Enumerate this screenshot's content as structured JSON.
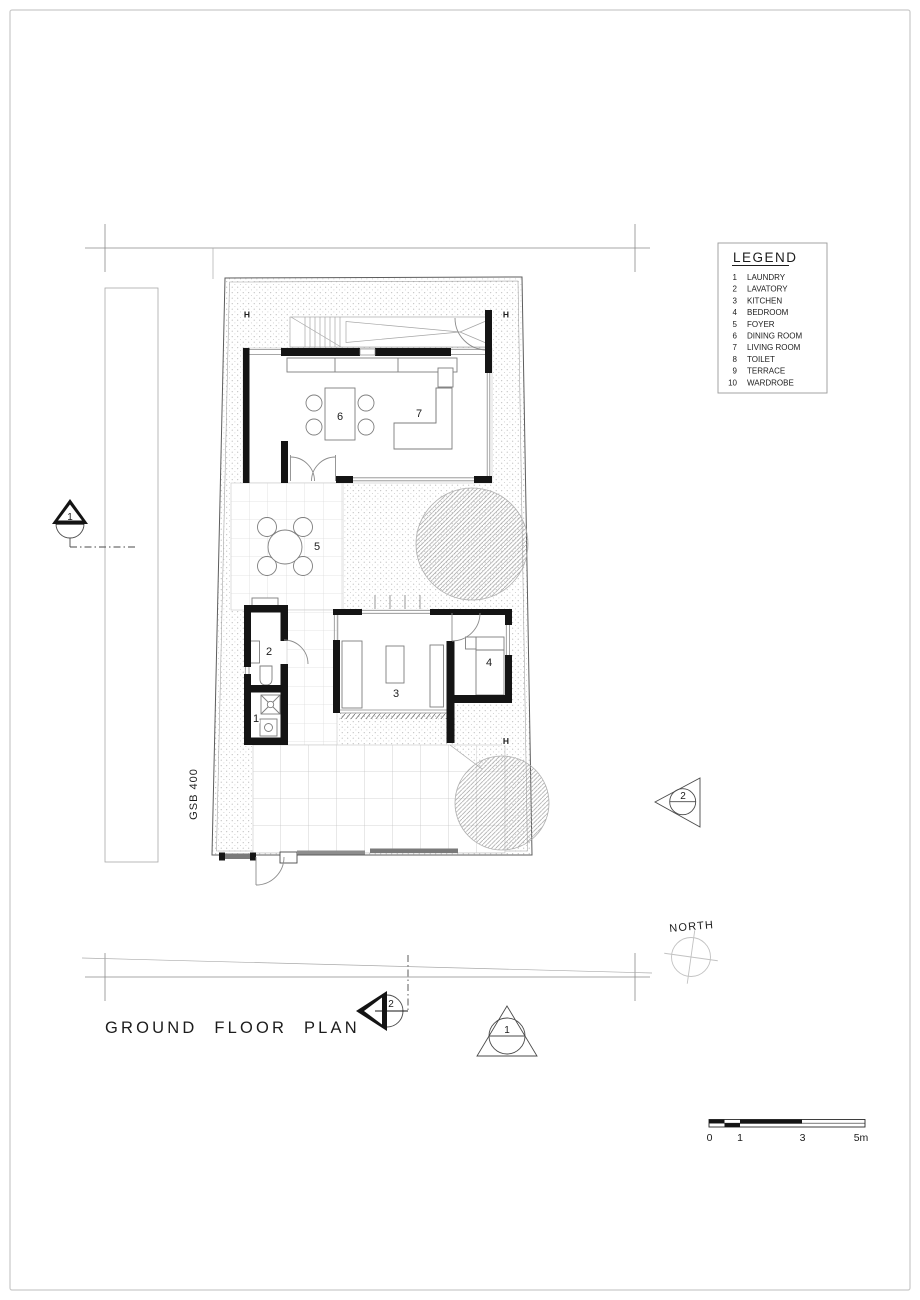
{
  "page": {
    "title": "GROUND FLOOR PLAN"
  },
  "legend": {
    "title": "LEGEND",
    "items": [
      {
        "num": "1",
        "label": "LAUNDRY"
      },
      {
        "num": "2",
        "label": "LAVATORY"
      },
      {
        "num": "3",
        "label": "KITCHEN"
      },
      {
        "num": "4",
        "label": "BEDROOM"
      },
      {
        "num": "5",
        "label": "FOYER"
      },
      {
        "num": "6",
        "label": "DINING ROOM"
      },
      {
        "num": "7",
        "label": "LIVING ROOM"
      },
      {
        "num": "8",
        "label": "TOILET"
      },
      {
        "num": "9",
        "label": "TERRACE"
      },
      {
        "num": "10",
        "label": "WARDROBE"
      }
    ]
  },
  "plan": {
    "room_labels": {
      "laundry": "1",
      "lavatory": "2",
      "kitchen": "3",
      "bedroom": "4",
      "foyer": "5",
      "dining": "6",
      "living": "7"
    },
    "column_label": "H",
    "wall_note": "GSB 400"
  },
  "markers": {
    "section_left": "1",
    "section_right": "2",
    "section_bottom": "2",
    "elevation_bottom": "1"
  },
  "compass": {
    "label": "NORTH"
  },
  "scale_bar": {
    "ticks": [
      "0",
      "1",
      "3",
      "5m"
    ]
  },
  "colors": {
    "wall": "#141414",
    "stipple": "#adadad",
    "accent": "#1c1c1c"
  }
}
